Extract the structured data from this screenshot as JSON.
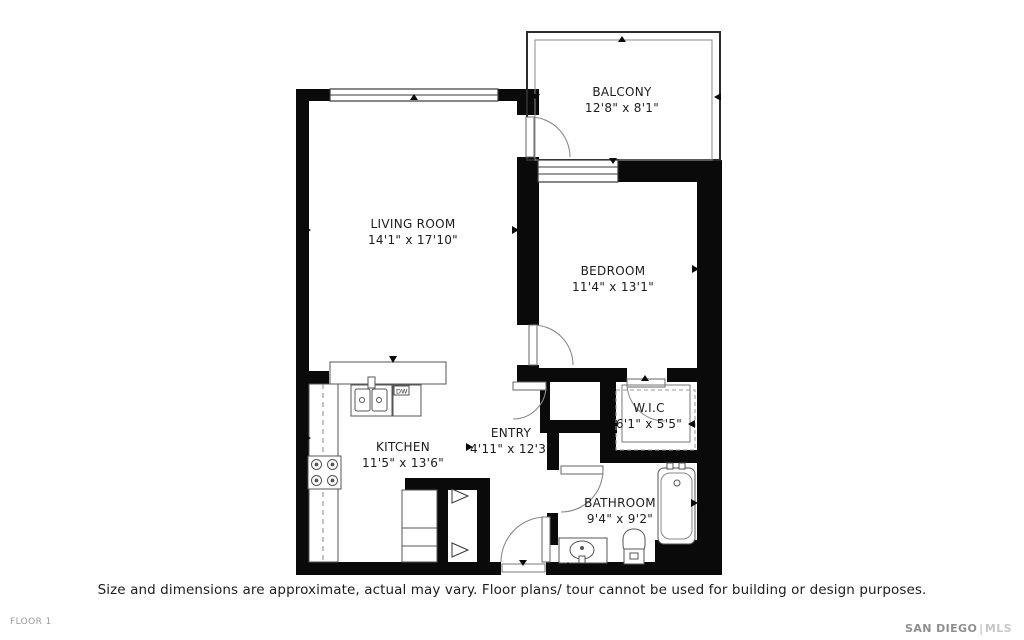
{
  "rooms": [
    {
      "id": "balcony",
      "name": "BALCONY",
      "dims": "12'8\" x 8'1\""
    },
    {
      "id": "living-room",
      "name": "LIVING ROOM",
      "dims": "14'1\" x 17'10\""
    },
    {
      "id": "bedroom",
      "name": "BEDROOM",
      "dims": "11'4\" x 13'1\""
    },
    {
      "id": "wic",
      "name": "W.I.C",
      "dims": "6'1\" x 5'5\""
    },
    {
      "id": "kitchen",
      "name": "KITCHEN",
      "dims": "11'5\" x 13'6\""
    },
    {
      "id": "entry",
      "name": "ENTRY",
      "dims": "4'11\" x 12'3\""
    },
    {
      "id": "bathroom",
      "name": "BATHROOM",
      "dims": "9'4\" x 9'2\""
    }
  ],
  "fixtures": {
    "dishwasher_label": "DW"
  },
  "footer": {
    "disclaimer": "Size and dimensions are approximate, actual may vary. Floor plans/ tour cannot be used for building or design purposes.",
    "floor_label": "FLOOR 1",
    "watermark_part1": "SAN DIEGO",
    "watermark_separator": "|",
    "watermark_part2": "MLS"
  },
  "colors": {
    "wall": "#0a0a0a",
    "fixture_line": "#555555",
    "door_arc": "#888888",
    "text": "#1c1c1c",
    "muted_text": "#9b9b9b",
    "watermark_text": "#c7c7c7"
  }
}
